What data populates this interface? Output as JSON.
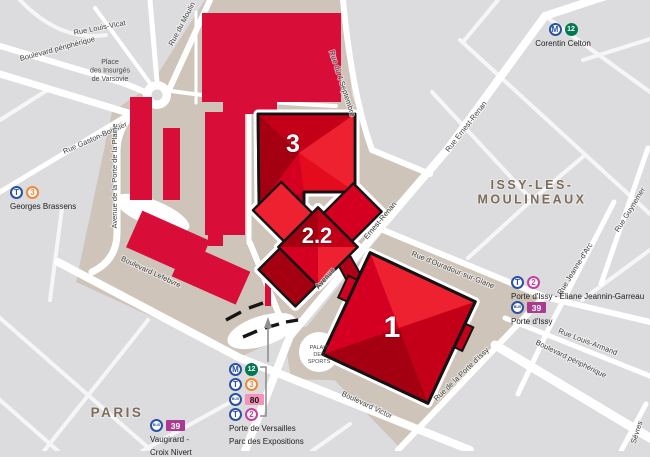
{
  "map": {
    "areas": [
      {
        "id": "paris",
        "lines": [
          "PARIS"
        ],
        "x": 117,
        "y": 417,
        "size": 13.5
      },
      {
        "id": "issy-les-moulineaux",
        "lines": [
          "ISSY-LES-",
          "MOULINEAUX"
        ],
        "x": 532,
        "y": 189,
        "size": 12.5
      }
    ],
    "street_labels": [
      {
        "text": "Rue Louis-Vicat",
        "x": 100,
        "y": 30,
        "r": -11
      },
      {
        "text": "Boulevard périphérique",
        "x": 58,
        "y": 51,
        "r": -15
      },
      {
        "text": "Rue Gaston-Boissier",
        "x": 96,
        "y": 140,
        "r": -24
      },
      {
        "text": "Rue du Moulin",
        "x": 184,
        "y": 25,
        "r": -62
      },
      {
        "text": "Avenue de la Porte de la Plaine",
        "x": 117,
        "y": 176,
        "r": -90
      },
      {
        "text": "Boulevard Lefebvre",
        "x": 150,
        "y": 274,
        "r": 25
      },
      {
        "text": "Rue du 4 Septembre",
        "x": 340,
        "y": 84,
        "r": 72
      },
      {
        "text": "Rue Ernest-Renan",
        "x": 468,
        "y": 128,
        "r": -52
      },
      {
        "text": "Ernest-Renan",
        "x": 382,
        "y": 222,
        "r": -50
      },
      {
        "text": "Avenue",
        "x": 327,
        "y": 280,
        "r": -50
      },
      {
        "text": "Rue d'Ouradour-sur-Glane",
        "x": 452,
        "y": 272,
        "r": 22
      },
      {
        "text": "Rue Jeanne-d'Arc",
        "x": 577,
        "y": 270,
        "r": -58
      },
      {
        "text": "Rue Guynemer",
        "x": 632,
        "y": 211,
        "r": -58
      },
      {
        "text": "Rue Louis-Armand",
        "x": 587,
        "y": 344,
        "r": 21
      },
      {
        "text": "Boulevard périphérique",
        "x": 570,
        "y": 361,
        "r": 26
      },
      {
        "text": "Rue de la Porte d'Issy",
        "x": 463,
        "y": 376,
        "r": -44
      },
      {
        "text": "Boulevard Victor",
        "x": 366,
        "y": 407,
        "r": 25
      },
      {
        "text": "Sèvres",
        "x": 639,
        "y": 433,
        "r": -72
      }
    ],
    "poi_labels": [
      {
        "id": "place-des-insurges",
        "lines": [
          "Place",
          "des Insurgés",
          "de Varsovie"
        ],
        "x": 110,
        "y": 64,
        "size": 7
      },
      {
        "id": "palais-des-sports",
        "lines": [
          "PALAIS",
          "DES",
          "SPORTS"
        ],
        "x": 319,
        "y": 349,
        "size": 5.5
      }
    ],
    "halls": [
      {
        "id": "hall-3",
        "label": "3",
        "x": 293,
        "y": 152,
        "size": 25
      },
      {
        "id": "hall-2-2",
        "label": "2.2",
        "x": 317,
        "y": 243,
        "size": 22
      },
      {
        "id": "hall-1",
        "label": "1",
        "x": 392,
        "y": 337,
        "size": 30
      }
    ]
  },
  "stations": [
    {
      "id": "corentin-celton",
      "x": 498,
      "y": 23,
      "w": 130,
      "align": "center",
      "rows": [
        [
          {
            "k": "m",
            "t": "M"
          },
          {
            "k": "l12",
            "t": "12"
          }
        ]
      ],
      "label": [
        "Corentin Celton"
      ]
    },
    {
      "id": "georges-brassens",
      "x": 10,
      "y": 186,
      "w": 120,
      "align": "left",
      "rows": [
        [
          {
            "k": "t",
            "t": "T"
          },
          {
            "k": "l3",
            "t": "3"
          }
        ]
      ],
      "label": [
        "Georges Brassens"
      ]
    },
    {
      "id": "porte-d-issy-tram",
      "x": 511,
      "y": 276,
      "w": 140,
      "align": "left",
      "rows": [
        [
          {
            "k": "t",
            "t": "T"
          },
          {
            "k": "l2",
            "t": "2"
          }
        ]
      ],
      "label": [
        "Porte d'Issy - Éliane Jeannin-Garreau"
      ]
    },
    {
      "id": "porte-d-issy-bus",
      "x": 511,
      "y": 301,
      "w": 100,
      "align": "left",
      "rows": [
        [
          {
            "k": "bus",
            "t": "BUS"
          },
          {
            "k": "b39",
            "t": "39"
          }
        ]
      ],
      "label": [
        "Porte d'Issy"
      ]
    },
    {
      "id": "porte-de-versailles",
      "x": 229,
      "y": 363,
      "w": 110,
      "align": "left",
      "rows": [
        [
          {
            "k": "m",
            "t": "M"
          },
          {
            "k": "l12",
            "t": "12"
          }
        ],
        [
          {
            "k": "t",
            "t": "T"
          },
          {
            "k": "l3",
            "t": "3"
          }
        ],
        [
          {
            "k": "bus",
            "t": "BUS"
          },
          {
            "k": "b80",
            "t": "80"
          }
        ],
        [
          {
            "k": "t",
            "t": "T"
          },
          {
            "k": "l2",
            "t": "2"
          }
        ]
      ],
      "label": [
        "Porte de Versailles",
        "Parc des Expositions"
      ]
    },
    {
      "id": "vaugirard-croix-nivert",
      "x": 150,
      "y": 419,
      "w": 90,
      "align": "left",
      "rows": [
        [
          {
            "k": "bus",
            "t": "BUS"
          },
          {
            "k": "b39",
            "t": "39"
          }
        ]
      ],
      "label": [
        "Vaugirard -",
        "Croix Nivert"
      ]
    }
  ],
  "colors": {
    "background": "#dcdcde",
    "street": "#ffffff",
    "expo_grounds": "#cfc4b9",
    "hall_red": "#d80d38",
    "highlight_red": "#e30b1c",
    "outline": "#141414",
    "metro_blue": "#2a51a3",
    "line12_green": "#007852",
    "line3_orange": "#f0883a",
    "line2_pink": "#c63f9d",
    "bus80_pink": "#f592ba",
    "bus39_magenta": "#a93b90",
    "city_label_brown": "#7d6c59",
    "street_label_gray": "#3f3f3f"
  }
}
